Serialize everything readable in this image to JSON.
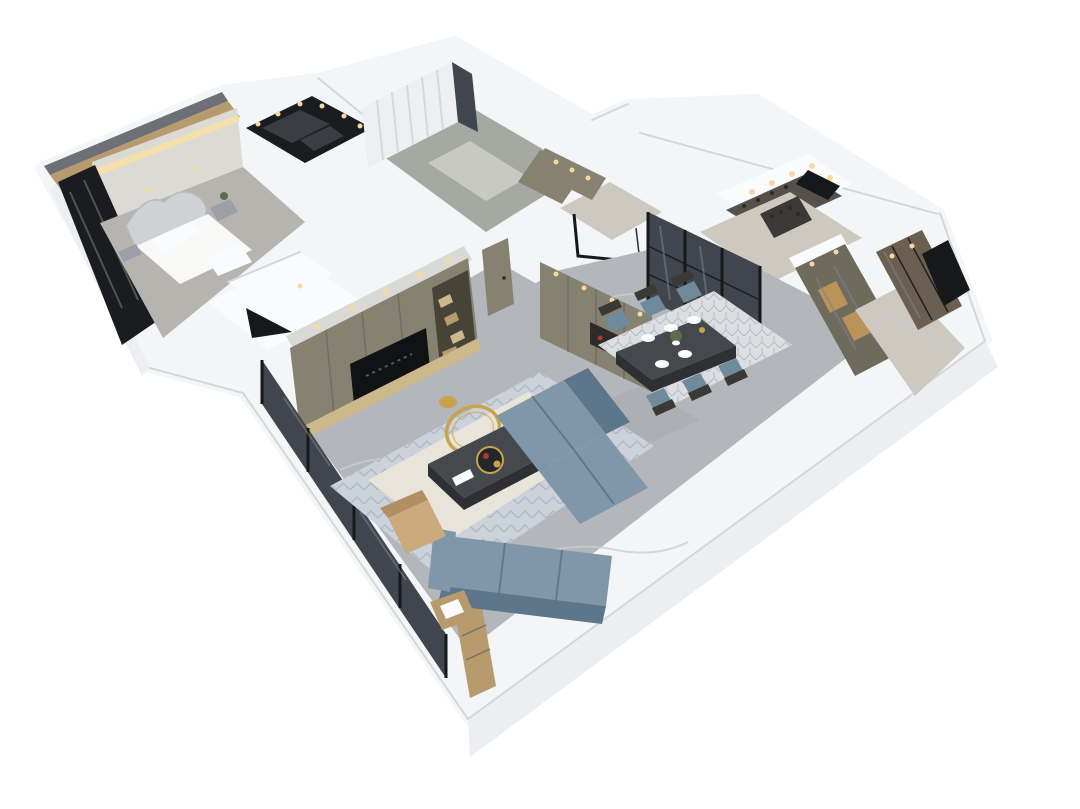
{
  "meta": {
    "type": "3d-floorplan-render",
    "description": "Photorealistic 3D dollhouse cutaway render of a modern apartment, viewed from an elevated three-quarter angle on a plain white background",
    "background": "#ffffff",
    "view": "elevated three-quarter cutaway (roofless dollhouse)"
  },
  "colors": {
    "bg": "#ffffff",
    "wall_white": "#f4f5f7",
    "wall_shade": "#eceef1",
    "wall_dark": "#dfe2e6",
    "seam": "#d4d7db",
    "steel": "#6d7177",
    "floor_marble": "#b3b6bb",
    "floor_vein": "#c9ccd1",
    "floor_warm": "#cdc8c0",
    "floor_green": "#a6a8a2",
    "mat": "#c9c9c3",
    "carpet": "#b6b4af",
    "accent_wall": "#dcdad4",
    "cove_light": "#f4e0ab",
    "curtain": "#edeff1",
    "curtain_stripe": "#d5d9dd",
    "wood": "#b79a6e",
    "wood_light": "#cdb88c",
    "counter": "#55504a",
    "wine_shelf": "#3b3835",
    "bottle": "#2c2a28",
    "glass_dark": "#1a1c20",
    "glass_mid": "#41464e",
    "glass_glare": "#7a818b",
    "olive": "#868171",
    "olive_dark": "#6e6a5c",
    "shelf_bg": "#474337",
    "shelf_gray": "#3a3d42",
    "soffit": "#d9d9d5",
    "niche_dark": "#2e2b28",
    "cabinet_warm": "#c89a58",
    "sofa": "#7f97a9",
    "sofa_dark": "#5e7689",
    "chair_blue": "#6f8a9b",
    "chair_frame": "#3b3934",
    "table_dark": "#45484d",
    "table_edge": "#2e3034",
    "rug_outer": "#ccd2da",
    "rug_inner": "#e8e4d9",
    "rug_pattern": "#a9b3c0",
    "dining_rug": "#dddee1",
    "dining_rug_pattern": "#b2b8c0",
    "gold": "#c9a24b",
    "tan": "#cbaa7e",
    "tan_dark": "#b28f62",
    "tv_screen": "#101214",
    "tv_logo": "#4b6563",
    "white_soft": "#fafbfc",
    "light_warm": "#f6d9a0",
    "bronze": "#6b5f52",
    "bed_white": "#f8f8f7",
    "headboard": "#d0d1d4",
    "metal": "#9aa0a6",
    "plant_green": "#5d6b4f",
    "red_decor": "#a83c30",
    "dark": "#17181a"
  },
  "scene": {
    "rooms": [
      {
        "name": "master-bedroom",
        "items": [
          "upholstered bed with ornate curved headboard",
          "white bedding and pillows",
          "nightstands with potted plant",
          "textured accent wall with warm cove lighting",
          "dark floor-to-ceiling window",
          "wood-clad balcony strip"
        ]
      },
      {
        "name": "walk-in-closet",
        "items": [
          "dark open wardrobe shelving",
          "recessed warm downlights around ceiling rim"
        ]
      },
      {
        "name": "study-room",
        "items": [
          "floor-to-ceiling sheer curtains",
          "smoked-glass panel",
          "built-in cabinet with warm downlights",
          "pale floor mat"
        ]
      },
      {
        "name": "entry-hall",
        "items": [
          "built-in storage cabinets with warm downlights",
          "black-framed glass balustrade"
        ]
      },
      {
        "name": "kitchen",
        "items": [
          "dark counter with wine bottles",
          "range hood",
          "white soffit with recessed downlights",
          "wine display shelf"
        ]
      },
      {
        "name": "glass-partition",
        "items": [
          "black-framed smoked-glass sliding doors between kitchen and dining"
        ]
      },
      {
        "name": "dining-room",
        "items": [
          "dark marble-top rectangular table",
          "six blue-gray upholstered chairs with dark wood frames",
          "white place-setting plates",
          "green floral centerpiece",
          "white geometric patterned rug"
        ]
      },
      {
        "name": "display-cabinet-wall",
        "items": [
          "olive built-in display cabinet with warm-lit glass niches"
        ]
      },
      {
        "name": "corridor",
        "items": [
          "bronze glass-front wardrobe",
          "dark entry door",
          "warm marble floor"
        ]
      },
      {
        "name": "hallway",
        "items": [
          "two olive interior doors",
          "built-in cabinet wall with display niche and red decor",
          "recessed downlights"
        ]
      },
      {
        "name": "living-room",
        "items": [
          "L-shaped blue-gray tufted sectional sofa",
          "dark marble coffee table with gold tray and red decor",
          "round gold ring decor piece",
          "gold side stool",
          "tan accent chair",
          "cream rug with blue-gray patterned border",
          "olive TV media wall with open shelving and wood boxes",
          "wall-mounted television with dark screen and faint logo",
          "lit soffit with downlights",
          "floor-to-ceiling windows with dark mullions",
          "gray marble flooring"
        ]
      },
      {
        "name": "utility-room",
        "items": [
          "white cabinetry and counter",
          "dark pass-through opening"
        ]
      }
    ]
  }
}
